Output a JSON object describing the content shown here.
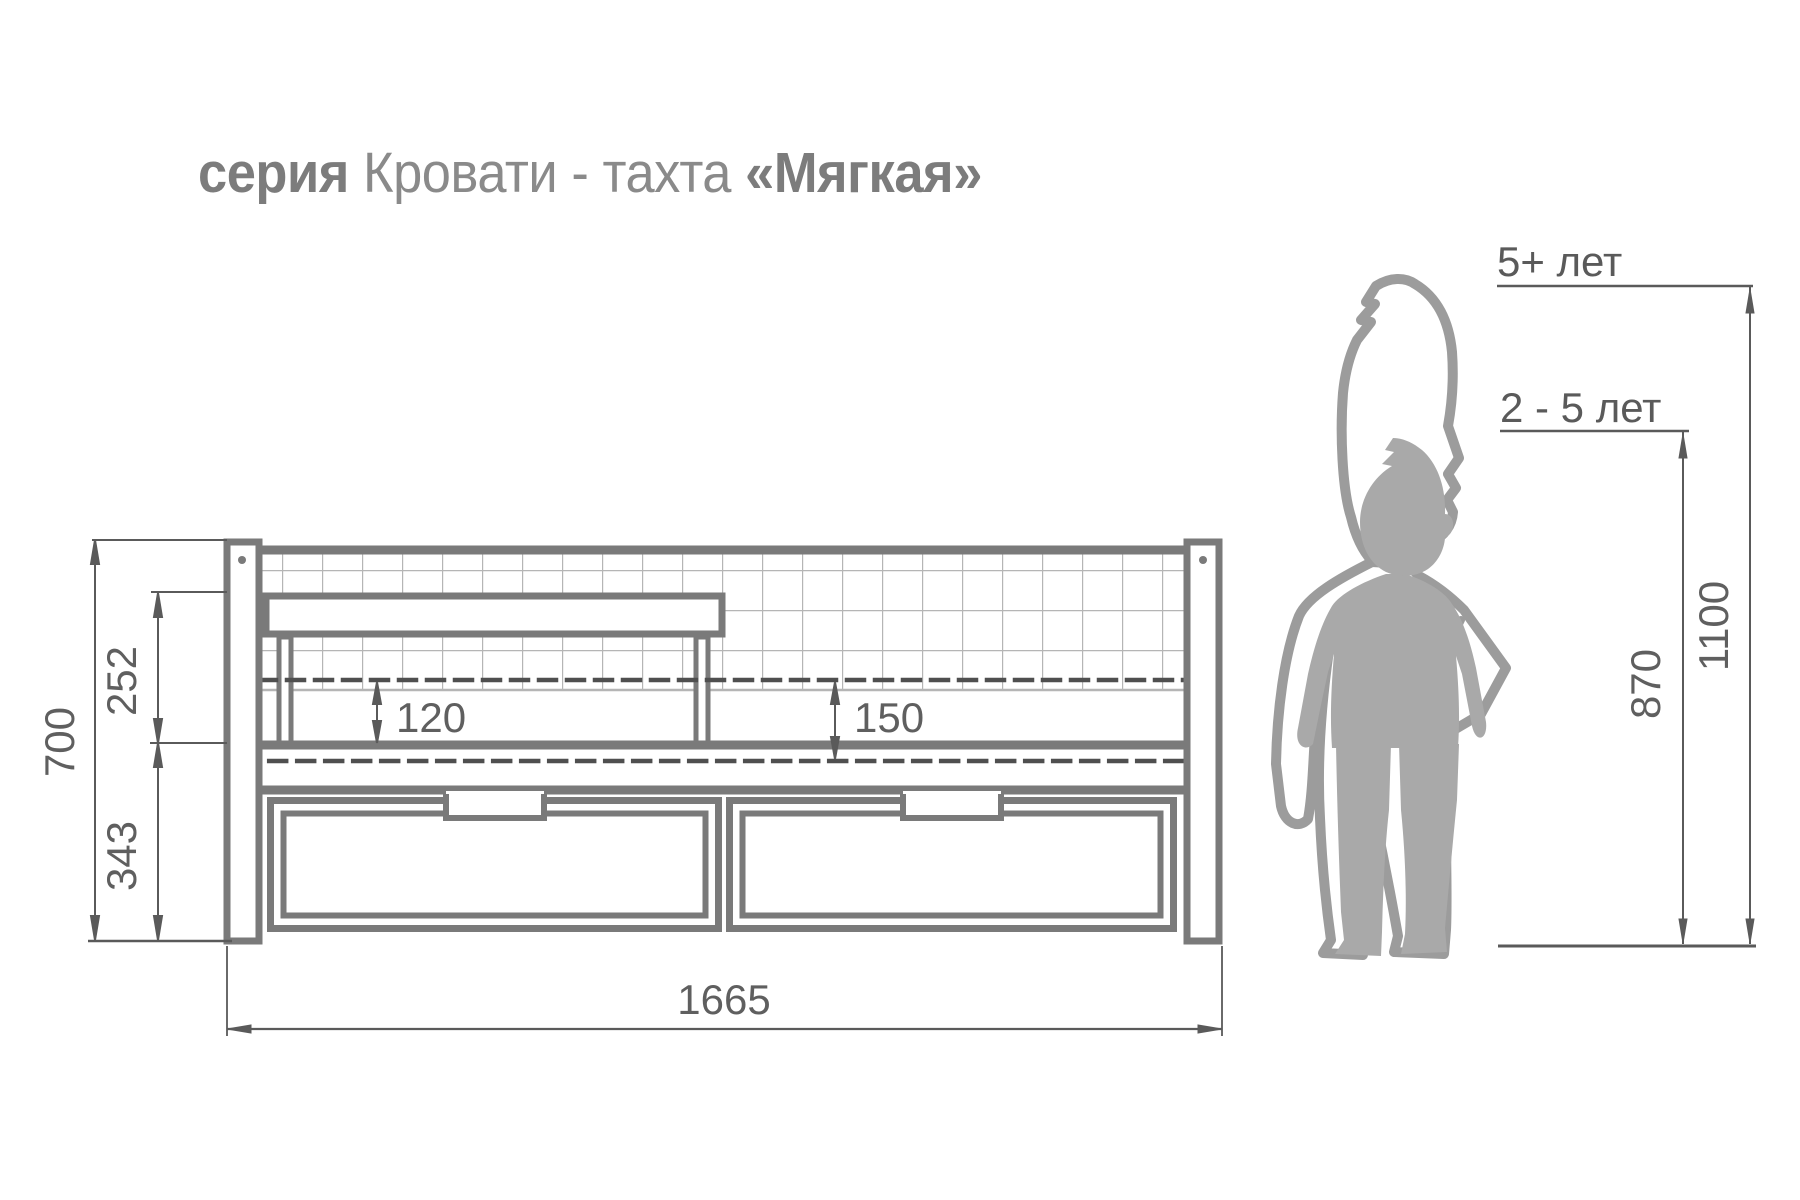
{
  "title": {
    "series_word": "серия ",
    "product": "Кровати - тахта ",
    "name": "«Мягкая»"
  },
  "dimensions": {
    "total_height": "700",
    "backrest_above_rail": "252",
    "base_height": "343",
    "mattress_left": "120",
    "mattress_right": "150",
    "total_length": "1665"
  },
  "age_guide": {
    "older_label": "5+ лет",
    "older_height": "1100",
    "younger_label": "2 - 5 лет",
    "younger_height": "870"
  },
  "colors": {
    "structure_line": "#7a7a7a",
    "grid_line": "#b5b5b5",
    "dashed_line": "#4f4f4f",
    "dimension_line": "#5a5a5a",
    "dimension_text": "#5f5f5f",
    "title_text": "#8a8a8a",
    "silhouette_solid": "#a9a9a9",
    "silhouette_outline": "#9c9c9c"
  }
}
